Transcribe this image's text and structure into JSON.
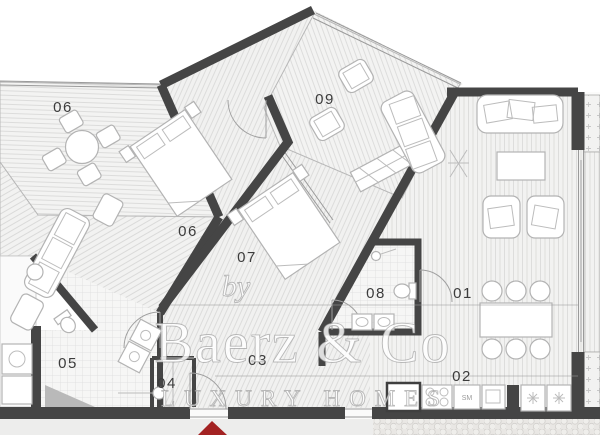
{
  "watermark": {
    "by": "by",
    "brand": "Baerz & Co",
    "tagline": "LUXURY HOMES"
  },
  "rooms": {
    "r01": {
      "label": "01",
      "type": "living-dining"
    },
    "r02": {
      "label": "02",
      "type": "kitchen"
    },
    "r03": {
      "label": "03",
      "type": "hallway"
    },
    "r04": {
      "label": "04",
      "type": "closet"
    },
    "r05": {
      "label": "05",
      "type": "bathroom"
    },
    "r06t": {
      "label": "06",
      "type": "terrace"
    },
    "r06b": {
      "label": "06",
      "type": "bedroom"
    },
    "r07": {
      "label": "07",
      "type": "bedroom"
    },
    "r08": {
      "label": "08",
      "type": "bathroom"
    },
    "r09": {
      "label": "09",
      "type": "terrace"
    }
  },
  "kitchen": {
    "sm_label": "SM"
  },
  "colors": {
    "wall": "#454545",
    "accent_red": "#a32222",
    "floor": "#f2f2f1"
  }
}
